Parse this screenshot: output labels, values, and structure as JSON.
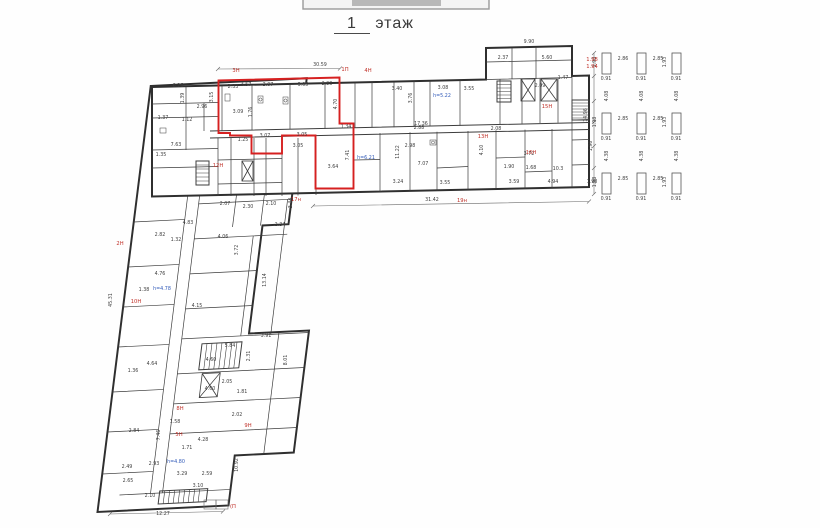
{
  "title": {
    "floor_number": "1",
    "floor_word": "этаж"
  },
  "colors": {
    "red_zone": "#d62020",
    "red_label": "#c03028",
    "blue_label": "#2f58b8",
    "wall": "#3c3c3c"
  },
  "red_zone": {
    "points": "218.5,80.5 339.5,77.5 339.5,123.5 353.5,123.5 353.5,188.5 315.5,188.5 315.5,135.5 282,135.5 282,153.5 251.5,153.5 251.5,135.5 230,135.5 230,133 218.5,133"
  },
  "labels": [
    {
      "t": "30.59",
      "x": 320,
      "y": 66
    },
    {
      "t": "9.90",
      "x": 529,
      "y": 43
    },
    {
      "t": "6.26",
      "x": 178,
      "y": 87
    },
    {
      "t": "3.57",
      "x": 246,
      "y": 86
    },
    {
      "t": "3.07",
      "x": 268,
      "y": 86
    },
    {
      "t": "3.05",
      "x": 303,
      "y": 86
    },
    {
      "t": "2.23",
      "x": 327,
      "y": 85
    },
    {
      "t": "2.33",
      "x": 233,
      "y": 88
    },
    {
      "t": "3.15",
      "x": 213,
      "y": 97,
      "r": -90
    },
    {
      "t": "1.39",
      "x": 184,
      "y": 98,
      "r": -90
    },
    {
      "t": "2.96",
      "x": 202,
      "y": 108
    },
    {
      "t": "1.12",
      "x": 187,
      "y": 121
    },
    {
      "t": "1.37",
      "x": 163,
      "y": 119
    },
    {
      "t": "7.63",
      "x": 176,
      "y": 146
    },
    {
      "t": "1.35",
      "x": 161,
      "y": 156
    },
    {
      "t": "3.09",
      "x": 238,
      "y": 113
    },
    {
      "t": "1.76",
      "x": 252,
      "y": 112,
      "r": -90
    },
    {
      "t": "4.70",
      "x": 337,
      "y": 104,
      "r": -90
    },
    {
      "t": "1.34",
      "x": 346,
      "y": 128
    },
    {
      "t": "7.41",
      "x": 349,
      "y": 155,
      "r": -90
    },
    {
      "t": "3.64",
      "x": 333,
      "y": 168
    },
    {
      "t": "3.05",
      "x": 298,
      "y": 147
    },
    {
      "t": "1.25",
      "x": 243,
      "y": 141
    },
    {
      "t": "3.07",
      "x": 265,
      "y": 137
    },
    {
      "t": "3.05",
      "x": 302,
      "y": 136
    },
    {
      "t": "3.40",
      "x": 397,
      "y": 90
    },
    {
      "t": "3.08",
      "x": 443,
      "y": 89
    },
    {
      "t": "3.55",
      "x": 469,
      "y": 90
    },
    {
      "t": "3.76",
      "x": 412,
      "y": 98,
      "r": -90
    },
    {
      "t": "2.37",
      "x": 503,
      "y": 59
    },
    {
      "t": "5.60",
      "x": 547,
      "y": 59
    },
    {
      "t": "2.09",
      "x": 540,
      "y": 87
    },
    {
      "t": "1.47",
      "x": 563,
      "y": 79
    },
    {
      "t": "17.36",
      "x": 421,
      "y": 125
    },
    {
      "t": "2.98",
      "x": 410,
      "y": 147
    },
    {
      "t": "11.22",
      "x": 399,
      "y": 152,
      "r": -90
    },
    {
      "t": "2.88",
      "x": 419,
      "y": 129
    },
    {
      "t": "2.08",
      "x": 496,
      "y": 130
    },
    {
      "t": "4.10",
      "x": 483,
      "y": 150,
      "r": -90
    },
    {
      "t": "1.90",
      "x": 509,
      "y": 168
    },
    {
      "t": "7.07",
      "x": 423,
      "y": 165
    },
    {
      "t": "3.24",
      "x": 398,
      "y": 183
    },
    {
      "t": "3.55",
      "x": 445,
      "y": 184
    },
    {
      "t": "3.59",
      "x": 514,
      "y": 183
    },
    {
      "t": "4.94",
      "x": 553,
      "y": 183
    },
    {
      "t": "3.72",
      "x": 529,
      "y": 155
    },
    {
      "t": "1.68",
      "x": 531,
      "y": 169
    },
    {
      "t": "10.3",
      "x": 558,
      "y": 170
    },
    {
      "t": "14.96",
      "x": 587,
      "y": 115,
      "r": -90
    },
    {
      "t": "1.96",
      "x": 592,
      "y": 146,
      "r": -90
    },
    {
      "t": "1.98",
      "x": 592,
      "y": 183
    },
    {
      "t": "31.42",
      "x": 432,
      "y": 201
    },
    {
      "t": "2.07",
      "x": 225,
      "y": 205
    },
    {
      "t": "2.30",
      "x": 248,
      "y": 208
    },
    {
      "t": "2.10",
      "x": 271,
      "y": 205
    },
    {
      "t": "3.44",
      "x": 292,
      "y": 203,
      "r": -90
    },
    {
      "t": "4.83",
      "x": 188,
      "y": 224
    },
    {
      "t": "2.82",
      "x": 160,
      "y": 236
    },
    {
      "t": "1.32",
      "x": 176,
      "y": 241
    },
    {
      "t": "4.06",
      "x": 223,
      "y": 238
    },
    {
      "t": "3.72",
      "x": 238,
      "y": 250,
      "r": -90
    },
    {
      "t": "2.34",
      "x": 280,
      "y": 226
    },
    {
      "t": "13.14",
      "x": 266,
      "y": 280,
      "r": -90
    },
    {
      "t": "4.15",
      "x": 197,
      "y": 307
    },
    {
      "t": "4.76",
      "x": 160,
      "y": 275
    },
    {
      "t": "1.38",
      "x": 144,
      "y": 291
    },
    {
      "t": "45.31",
      "x": 112,
      "y": 300,
      "r": -90
    },
    {
      "t": "4.64",
      "x": 152,
      "y": 365
    },
    {
      "t": "1.36",
      "x": 133,
      "y": 372
    },
    {
      "t": "3.91",
      "x": 266,
      "y": 337
    },
    {
      "t": "5.84",
      "x": 230,
      "y": 347
    },
    {
      "t": "4.60",
      "x": 211,
      "y": 361
    },
    {
      "t": "2.31",
      "x": 250,
      "y": 356,
      "r": -90
    },
    {
      "t": "2.05",
      "x": 227,
      "y": 383
    },
    {
      "t": "1.81",
      "x": 242,
      "y": 393
    },
    {
      "t": "2.02",
      "x": 237,
      "y": 416
    },
    {
      "t": "8.01",
      "x": 287,
      "y": 360,
      "r": -90
    },
    {
      "t": "10.92",
      "x": 238,
      "y": 465,
      "r": -90
    },
    {
      "t": "4.60",
      "x": 210,
      "y": 390
    },
    {
      "t": "2.84",
      "x": 134,
      "y": 432
    },
    {
      "t": "1.58",
      "x": 175,
      "y": 423
    },
    {
      "t": "7.46",
      "x": 160,
      "y": 435,
      "r": -90
    },
    {
      "t": "1.71",
      "x": 187,
      "y": 449
    },
    {
      "t": "4.28",
      "x": 203,
      "y": 441
    },
    {
      "t": "2.93",
      "x": 154,
      "y": 465
    },
    {
      "t": "3.29",
      "x": 182,
      "y": 475
    },
    {
      "t": "2.59",
      "x": 207,
      "y": 475
    },
    {
      "t": "2.49",
      "x": 127,
      "y": 468
    },
    {
      "t": "2.65",
      "x": 128,
      "y": 482
    },
    {
      "t": "3.10",
      "x": 198,
      "y": 487
    },
    {
      "t": "2.10",
      "x": 150,
      "y": 497
    },
    {
      "t": "12.27",
      "x": 163,
      "y": 515
    },
    {
      "t": "0.91",
      "x": 606,
      "y": 80
    },
    {
      "t": "0.91",
      "x": 641,
      "y": 80
    },
    {
      "t": "0.91",
      "x": 676,
      "y": 80
    },
    {
      "t": "0.91",
      "x": 606,
      "y": 140
    },
    {
      "t": "0.91",
      "x": 641,
      "y": 140
    },
    {
      "t": "0.91",
      "x": 676,
      "y": 140
    },
    {
      "t": "0.91",
      "x": 606,
      "y": 200
    },
    {
      "t": "0.91",
      "x": 641,
      "y": 200
    },
    {
      "t": "0.91",
      "x": 676,
      "y": 200
    },
    {
      "t": "2.86",
      "x": 623,
      "y": 60
    },
    {
      "t": "2.85",
      "x": 658,
      "y": 60
    },
    {
      "t": "2.85",
      "x": 623,
      "y": 120
    },
    {
      "t": "2.85",
      "x": 658,
      "y": 120
    },
    {
      "t": "2.85",
      "x": 623,
      "y": 180
    },
    {
      "t": "2.85",
      "x": 658,
      "y": 180
    },
    {
      "t": "1.98",
      "x": 596,
      "y": 62,
      "r": -90
    },
    {
      "t": "1.93",
      "x": 666,
      "y": 62,
      "r": -90
    },
    {
      "t": "1.98",
      "x": 596,
      "y": 122,
      "r": -90
    },
    {
      "t": "1.93",
      "x": 666,
      "y": 122,
      "r": -90
    },
    {
      "t": "1.98",
      "x": 596,
      "y": 182,
      "r": -90
    },
    {
      "t": "1.93",
      "x": 666,
      "y": 182,
      "r": -90
    },
    {
      "t": "4.08",
      "x": 608,
      "y": 96,
      "r": -90
    },
    {
      "t": "4.08",
      "x": 643,
      "y": 96,
      "r": -90
    },
    {
      "t": "4.08",
      "x": 678,
      "y": 96,
      "r": -90
    },
    {
      "t": "4.38",
      "x": 608,
      "y": 156,
      "r": -90
    },
    {
      "t": "4.38",
      "x": 643,
      "y": 156,
      "r": -90
    },
    {
      "t": "4.38",
      "x": 678,
      "y": 156,
      "r": -90
    },
    {
      "t": "3H",
      "x": 236,
      "y": 72,
      "c": "red"
    },
    {
      "t": "1П",
      "x": 345,
      "y": 71,
      "c": "red"
    },
    {
      "t": "4H",
      "x": 368,
      "y": 72,
      "c": "red"
    },
    {
      "t": "1.98",
      "x": 592,
      "y": 61,
      "c": "red"
    },
    {
      "t": "1.94",
      "x": 592,
      "y": 68,
      "c": "red"
    },
    {
      "t": "15H",
      "x": 547,
      "y": 108,
      "c": "red"
    },
    {
      "t": "16H",
      "x": 531,
      "y": 154,
      "c": "red"
    },
    {
      "t": "13H",
      "x": 483,
      "y": 138,
      "c": "red"
    },
    {
      "t": "12H",
      "x": 218,
      "y": 167,
      "c": "red"
    },
    {
      "t": "17н",
      "x": 296,
      "y": 201,
      "c": "red"
    },
    {
      "t": "19н",
      "x": 462,
      "y": 202,
      "c": "red"
    },
    {
      "t": "2H",
      "x": 120,
      "y": 245,
      "c": "red"
    },
    {
      "t": "10H",
      "x": 136,
      "y": 303,
      "c": "red"
    },
    {
      "t": "8H",
      "x": 180,
      "y": 410,
      "c": "red"
    },
    {
      "t": "5H",
      "x": 179,
      "y": 436,
      "c": "red"
    },
    {
      "t": "9H",
      "x": 248,
      "y": 427,
      "c": "red"
    },
    {
      "t": "(П",
      "x": 233,
      "y": 508,
      "c": "red"
    },
    {
      "t": "h=5.22",
      "x": 442,
      "y": 97,
      "c": "blue"
    },
    {
      "t": "h=6.21",
      "x": 366,
      "y": 159,
      "c": "blue"
    },
    {
      "t": "h=4.78",
      "x": 162,
      "y": 290,
      "c": "blue"
    },
    {
      "t": "h=4.80",
      "x": 176,
      "y": 463,
      "c": "blue"
    }
  ]
}
